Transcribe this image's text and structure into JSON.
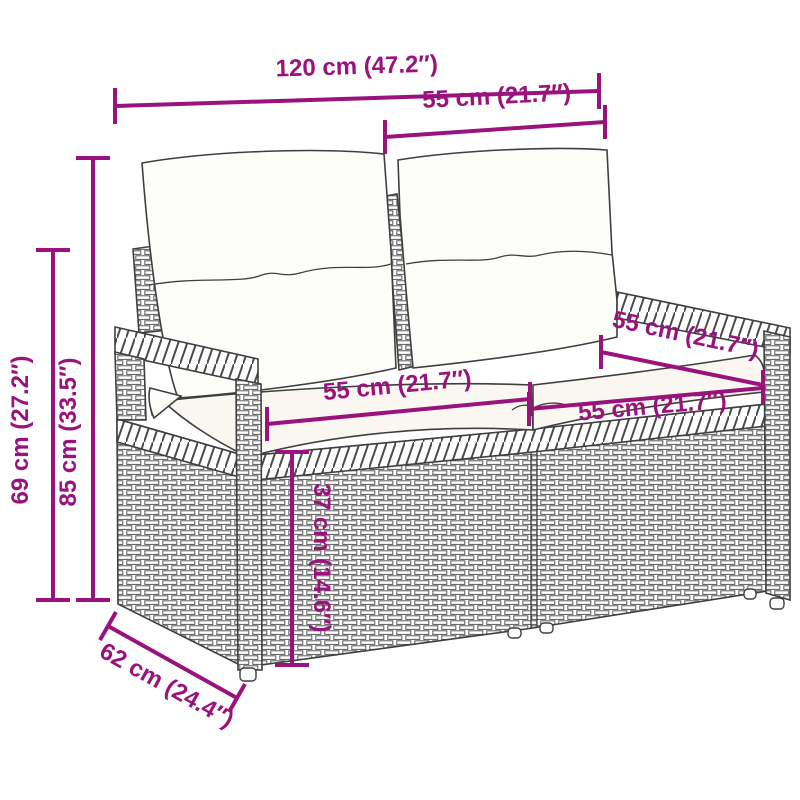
{
  "diagram": {
    "type": "product-dimension-diagram",
    "subject": "poly-rattan 2-seater garden sofa with back and seat cushions",
    "accent_color": "#9A127C",
    "line_color": "#3f3f3f",
    "dimensions": [
      {
        "id": "total-width",
        "label": "120 cm (47.2″)"
      },
      {
        "id": "back-section-width",
        "label": "55 cm (21.7″)"
      },
      {
        "id": "total-height",
        "label": "85 cm (33.5″)"
      },
      {
        "id": "armrest-height",
        "label": "69 cm (27.2″)"
      },
      {
        "id": "seat-left-width",
        "label": "55 cm (21.7″)"
      },
      {
        "id": "seat-right-width",
        "label": "55 cm (21.7″)"
      },
      {
        "id": "seat-depth",
        "label": "55 cm (21.7″)"
      },
      {
        "id": "seat-height",
        "label": "37 cm (14.6″)"
      },
      {
        "id": "total-depth",
        "label": "62 cm (24.4″)"
      }
    ]
  }
}
